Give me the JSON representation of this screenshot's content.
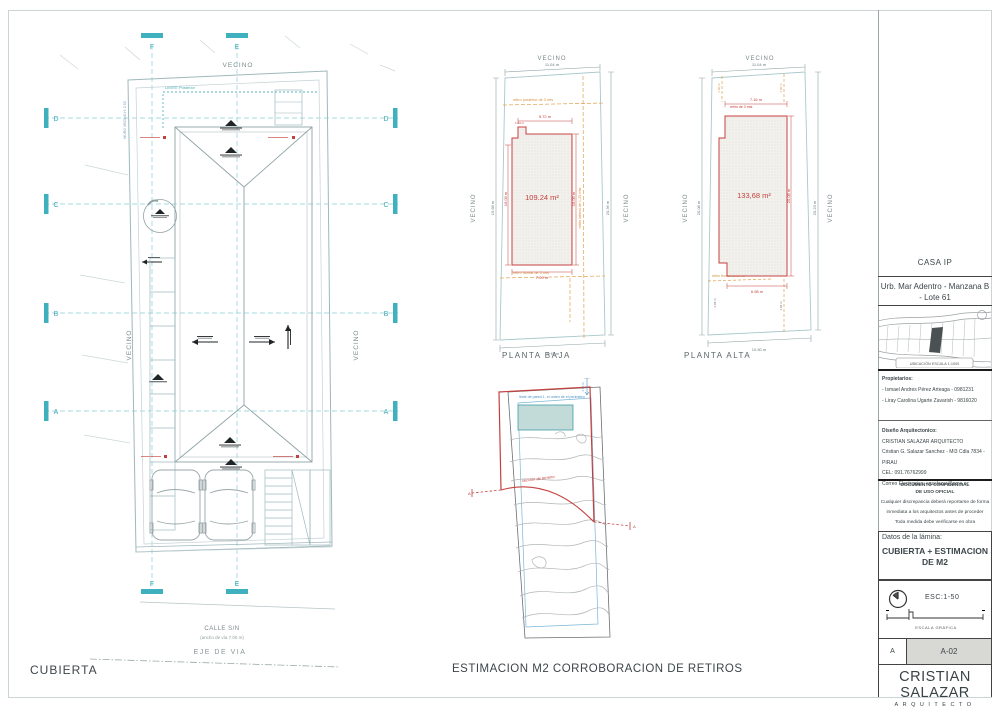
{
  "sheet": {
    "title_left": "CUBIERTA",
    "title_center": "ESTIMACION M2 CORROBORACION DE RETIROS"
  },
  "colors": {
    "teal": "#3fb0bd",
    "red": "#c4403e",
    "orange": "#e0a14e",
    "blue": "#4a90c4"
  },
  "roof_plan": {
    "grid": {
      "col_left": "F",
      "col_right": "E",
      "row_1": "D",
      "row_2": "C",
      "row_3": "B",
      "row_4": "A"
    },
    "vecino": "VECINO",
    "limite_posterior": "LIMITE Posterior",
    "muro_vecino": "MURO VECINO H: 2.50",
    "calle": "CALLE S/N",
    "calle_ancho": "(ancho de vía 7.00 m)",
    "eje_de_via": "EJE DE VIA"
  },
  "planta_baja": {
    "title": "PLANTA BAJA",
    "area": "109.24 m²",
    "vecino": "VECINO",
    "dim_top": "11.04 m",
    "dim_bottom": "10.43 m",
    "dim_left": "19.68 m",
    "dim_right": "20.36 m",
    "dim_red_top": "5.72 m",
    "dim_red_bottom": "7.20 m",
    "dim_red_right": "16.06 m",
    "dim_red_left": "16.06 m",
    "dim_red_notch": "1.43 m",
    "retiro_posterior": "retiro posterior de 3 mts",
    "retiro_frontal": "retiro frontal de 5 mts",
    "retiro_lateral": "retiro lateral de 1.25 mts"
  },
  "planta_alta": {
    "title": "PLANTA ALTA",
    "area": "133,68 m²",
    "vecino": "VECINO",
    "dim_top": "11.04 m",
    "dim_bottom": "10.50 m",
    "dim_left": "20.08 m",
    "dim_right": "20.23 m",
    "dim_red_top": "7.16 m",
    "dim_red_bottom": "6.98 m",
    "dim_red_right": "20.08 m",
    "dim_orange_left": "1.00 m",
    "dim_orange_right": "1.00 m",
    "dim_small_left": "3.08 m",
    "dim_small_right": "1.08 m",
    "retiro_top": "retiro de 3 mts",
    "retiro_frontal": "retiro frontal de 5 mts"
  },
  "site_plan": {
    "note_top": "linde de pared 1, el orden de el perimetro",
    "note_dim": "1.00 m",
    "note_red": "sección de terreno",
    "marker_left": "A",
    "marker_right": "A"
  },
  "title_block": {
    "project": "CASA IP",
    "location_line1": "Urb. Mar Adentro - Manzana B",
    "location_line2": "- Lote 61",
    "map_caption": "UBICACIÓN ESCALA 1:1000",
    "owners_label": "Propietarios:",
    "owner_1": "- Ismael Andres Pérez Arteaga - 0981231",
    "owner_2": "- Liray Carolina Ugarte Zavarish - 9816020",
    "design_label": "Diseño Arquitectonico:",
    "design_firm": "CRISTIAN SALAZAR ARQUITECTO",
    "design_address": "Cristian G. Salazar Sanchez - MI3 Cdla 7834 - PIRAU",
    "design_phone": "CEL: 091.76762999",
    "design_email": "Correo Electronico: cgsalazar@oma.ec",
    "confidential_line1": "DOCUMENTO CONFIDENCIAL",
    "confidential_line2": "DE USO OFICIAL",
    "note_1": "Cualquier discrepancia deberá reportarse de forma",
    "note_2": "inmediata a los arquitectos antes de proceder",
    "note_3": "Toda medida debe verificarse en obra",
    "datos_label": "Datos de la lámina:",
    "sheet_name": "CUBIERTA + ESTIMACION DE M2",
    "scale": "ESC:1-50",
    "scale_caption": "ESCALA GRÁFICA",
    "revision": "A",
    "sheet_number": "A-02",
    "firm_name": "CRISTIAN SALAZAR",
    "firm_sub": "ARQUITECTO"
  }
}
